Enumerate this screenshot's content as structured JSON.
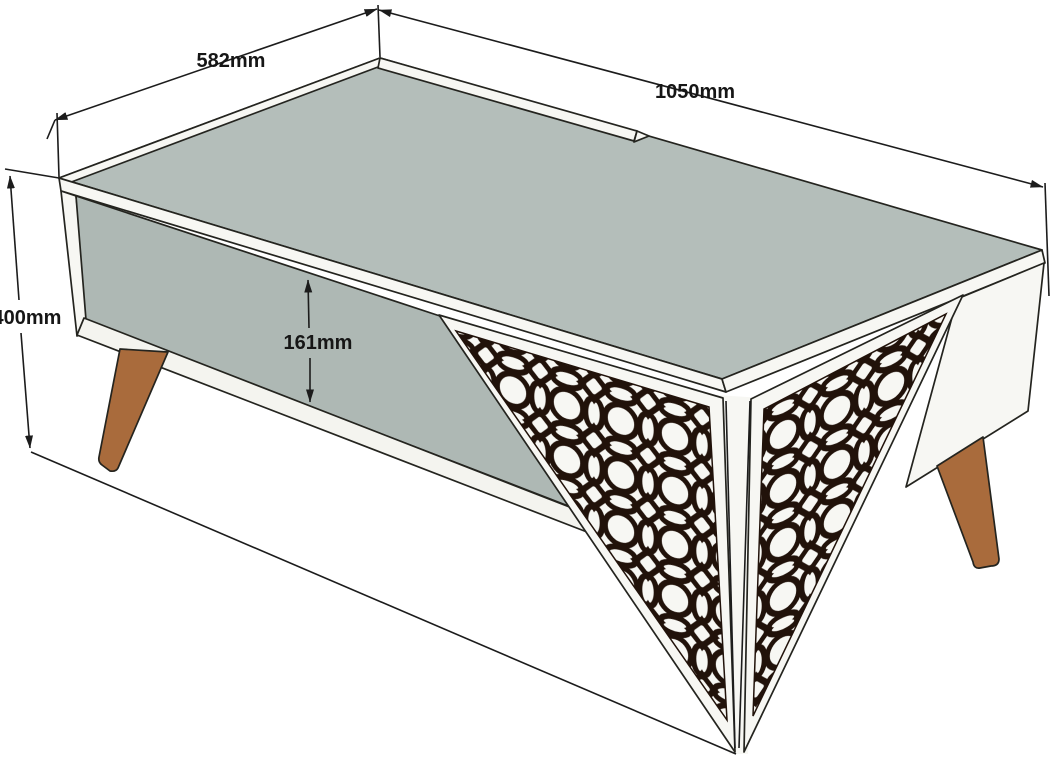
{
  "title": "Coffee table dimensioned drawing",
  "diagram": {
    "type": "furniture-dimension-drawing",
    "subject": "coffee table with decorative V-panel and open shelf"
  },
  "labels": {
    "width": "582mm",
    "length": "1050mm",
    "height": "400mm",
    "opening": "161mm"
  },
  "colors": {
    "top_surface": "#b4beba",
    "interior": "#aeb8b4",
    "shelf_band": "#f4f4ef",
    "panel_white": "#f7f7f3",
    "pattern_dark": "#21120a",
    "leg": "#a96b3c",
    "line": "#1c1c1c",
    "background": "#ffffff"
  }
}
